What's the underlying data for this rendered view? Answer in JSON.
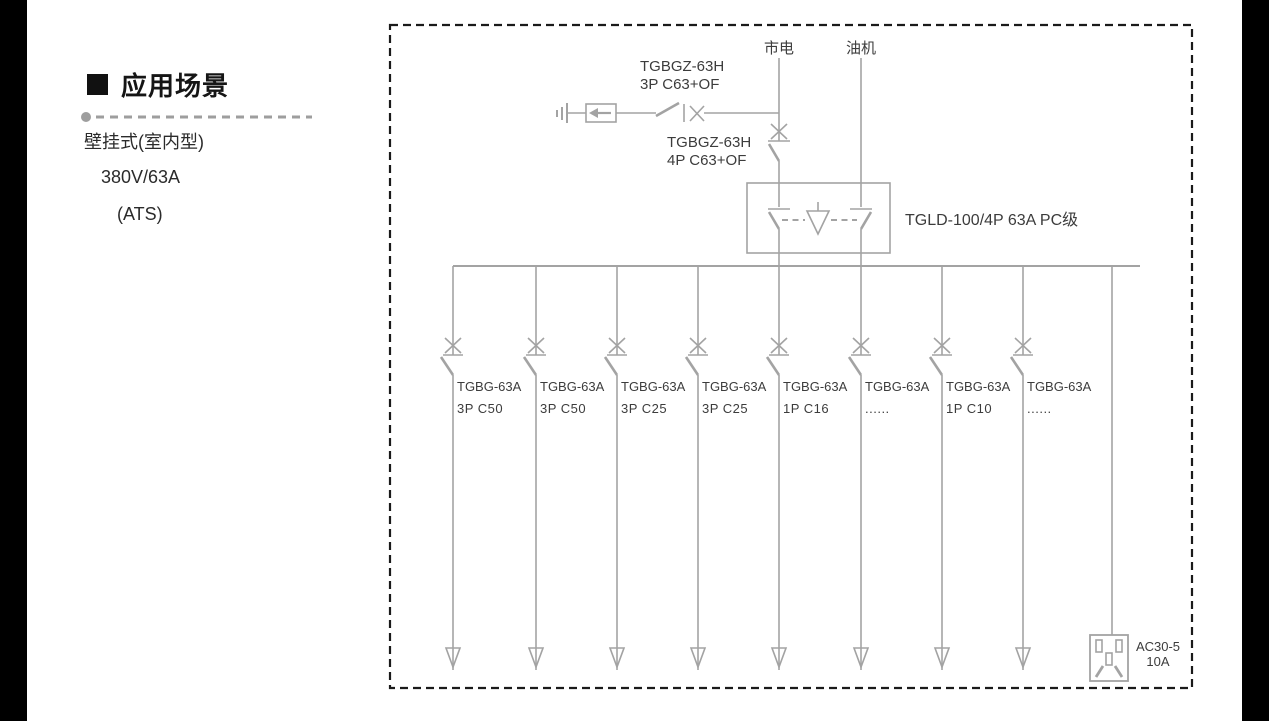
{
  "left_panel": {
    "heading": "应用场景",
    "lines": [
      "壁挂式(室内型)",
      "380V/63A",
      "(ATS)"
    ]
  },
  "diagram": {
    "sources": {
      "mains": "市电",
      "generator": "油机"
    },
    "incoming_breaker_3p": {
      "model": "TGBGZ-63H",
      "rating": "3P C63+OF"
    },
    "incoming_breaker_4p": {
      "model": "TGBGZ-63H",
      "rating": "4P C63+OF"
    },
    "ats": {
      "label": "TGLD-100/4P 63A PC级"
    },
    "branches": [
      {
        "model": "TGBG-63A",
        "rating": "3P C50"
      },
      {
        "model": "TGBG-63A",
        "rating": "3P C50"
      },
      {
        "model": "TGBG-63A",
        "rating": "3P C25"
      },
      {
        "model": "TGBG-63A",
        "rating": "3P C25"
      },
      {
        "model": "TGBG-63A",
        "rating": "1P C16"
      },
      {
        "model": "TGBG-63A",
        "rating": "......"
      },
      {
        "model": "TGBG-63A",
        "rating": "1P C10"
      },
      {
        "model": "TGBG-63A",
        "rating": "......"
      }
    ],
    "socket": {
      "model": "AC30-5",
      "rating": "10A"
    }
  },
  "colors": {
    "diagram_line": "#a3a3a3",
    "diagram_text": "#3c3c3c",
    "border_dash": "#1a1a1a",
    "heading_text": "#151515",
    "divider": "#9e9e9e",
    "frame_bar": "#000000"
  }
}
